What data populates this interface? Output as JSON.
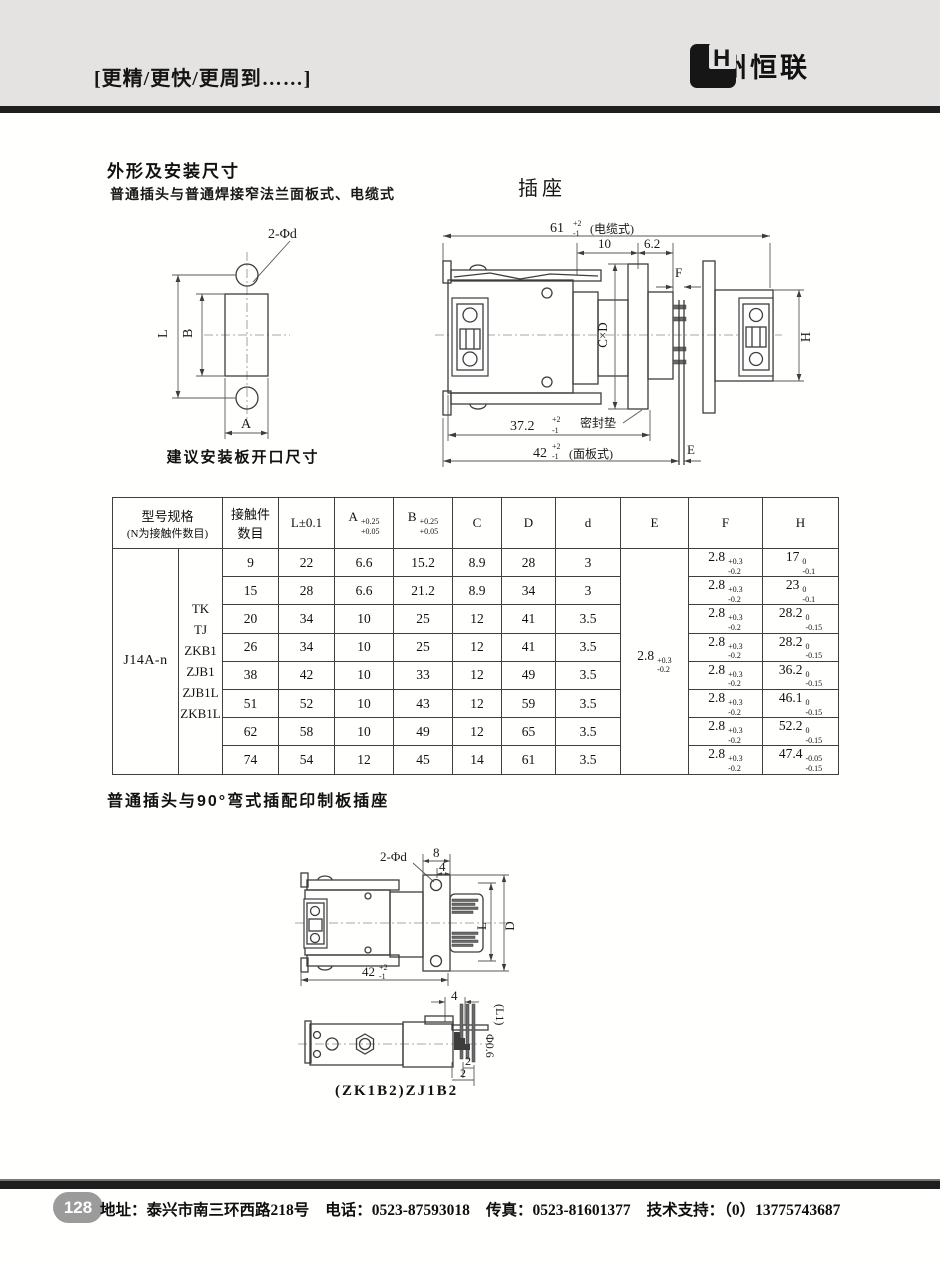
{
  "colors": {
    "header_bg": "#e4e3e1",
    "bar": "#1f1f1f",
    "badge": "#9b9b9b"
  },
  "header": {
    "slogan": "[更精/更快/更周到……]",
    "logo_text": "H",
    "brand": "泰州恒联"
  },
  "section1": {
    "title": "外形及安装尺寸",
    "subtitle": "普通插头与普通焊接窄法兰面板式、电缆式",
    "socket_label": "插座",
    "plate_drawing": {
      "holes_label": "2-Φd",
      "dim_L": "L",
      "dim_B": "B",
      "dim_A": "A",
      "caption": "建议安装板开口尺寸"
    },
    "socket_drawing": {
      "dim61": "61",
      "dim61_up": "+2",
      "dim61_dn": "-1",
      "dim61_note": "(电缆式)",
      "dim10": "10",
      "dim62": "6.2",
      "dimF": "F",
      "dimCxD": "C×D",
      "dimH": "H",
      "dim372": "37.2",
      "dim372_up": "+2",
      "dim372_dn": "-1",
      "seal": "密封垫",
      "dim42": "42",
      "dim42_up": "+2",
      "dim42_dn": "-1",
      "dim42_note": "(面板式)",
      "dimE": "E"
    }
  },
  "table": {
    "col_model_line1": "型号规格",
    "col_model_line2": "(N为接触件数目)",
    "col_contacts_line1": "接触件",
    "col_contacts_line2": "数目",
    "col_L": "L±0.1",
    "col_A": "A",
    "col_A_up": "+0.25",
    "col_A_dn": "+0.05",
    "col_B": "B",
    "col_B_up": "+0.25",
    "col_B_dn": "+0.05",
    "col_C": "C",
    "col_D": "D",
    "col_d": "d",
    "col_E": "E",
    "col_F": "F",
    "col_H": "H",
    "model": "J14A-n",
    "variants": [
      "TK",
      "TJ",
      "ZKB1",
      "ZJB1",
      "ZJB1L",
      "ZKB1L"
    ],
    "E_val": "2.8",
    "E_up": "+0.3",
    "E_dn": "-0.2",
    "rows": [
      {
        "contacts": "9",
        "L": "22",
        "A": "6.6",
        "B": "15.2",
        "C": "8.9",
        "D": "28",
        "d": "3",
        "F": "2.8",
        "F_up": "+0.3",
        "F_dn": "-0.2",
        "H": "17",
        "H_up": "0",
        "H_dn": "-0.1"
      },
      {
        "contacts": "15",
        "L": "28",
        "A": "6.6",
        "B": "21.2",
        "C": "8.9",
        "D": "34",
        "d": "3",
        "F": "2.8",
        "F_up": "+0.3",
        "F_dn": "-0.2",
        "H": "23",
        "H_up": "0",
        "H_dn": "-0.1"
      },
      {
        "contacts": "20",
        "L": "34",
        "A": "10",
        "B": "25",
        "C": "12",
        "D": "41",
        "d": "3.5",
        "F": "2.8",
        "F_up": "+0.3",
        "F_dn": "-0.2",
        "H": "28.2",
        "H_up": "0",
        "H_dn": "-0.15"
      },
      {
        "contacts": "26",
        "L": "34",
        "A": "10",
        "B": "25",
        "C": "12",
        "D": "41",
        "d": "3.5",
        "F": "2.8",
        "F_up": "+0.3",
        "F_dn": "-0.2",
        "H": "28.2",
        "H_up": "0",
        "H_dn": "-0.15"
      },
      {
        "contacts": "38",
        "L": "42",
        "A": "10",
        "B": "33",
        "C": "12",
        "D": "49",
        "d": "3.5",
        "F": "2.8",
        "F_up": "+0.3",
        "F_dn": "-0.2",
        "H": "36.2",
        "H_up": "0",
        "H_dn": "-0.15"
      },
      {
        "contacts": "51",
        "L": "52",
        "A": "10",
        "B": "43",
        "C": "12",
        "D": "59",
        "d": "3.5",
        "F": "2.8",
        "F_up": "+0.3",
        "F_dn": "-0.2",
        "H": "46.1",
        "H_up": "0",
        "H_dn": "-0.15"
      },
      {
        "contacts": "62",
        "L": "58",
        "A": "10",
        "B": "49",
        "C": "12",
        "D": "65",
        "d": "3.5",
        "F": "2.8",
        "F_up": "+0.3",
        "F_dn": "-0.2",
        "H": "52.2",
        "H_up": "0",
        "H_dn": "-0.15"
      },
      {
        "contacts": "74",
        "L": "54",
        "A": "12",
        "B": "45",
        "C": "14",
        "D": "61",
        "d": "3.5",
        "F": "2.8",
        "F_up": "+0.3",
        "F_dn": "-0.2",
        "H": "47.4",
        "H_up": "-0.05",
        "H_dn": "-0.15"
      }
    ]
  },
  "section2": {
    "title": "普通插头与90°弯式插配印制板插座",
    "plug_drawing": {
      "holes_label": "2-Φd",
      "dim8": "8",
      "dim4": "4",
      "dimL": "L",
      "dimD": "D",
      "dim42": "42",
      "dim42_up": "+2",
      "dim42_dn": "-1"
    },
    "pcb_drawing": {
      "dim4": "4",
      "dimL1": "(L1)",
      "dim06": "Φ0.6",
      "dim2a": "2",
      "dim2b": "2",
      "caption": "(ZK1B2)ZJ1B2"
    }
  },
  "footer": {
    "page_number": "128",
    "address": "地址：泰兴市南三环西路218号",
    "phone": "电话：0523-87593018",
    "fax": "传真：0523-81601377",
    "support": "技术支持：（0）13775743687"
  }
}
